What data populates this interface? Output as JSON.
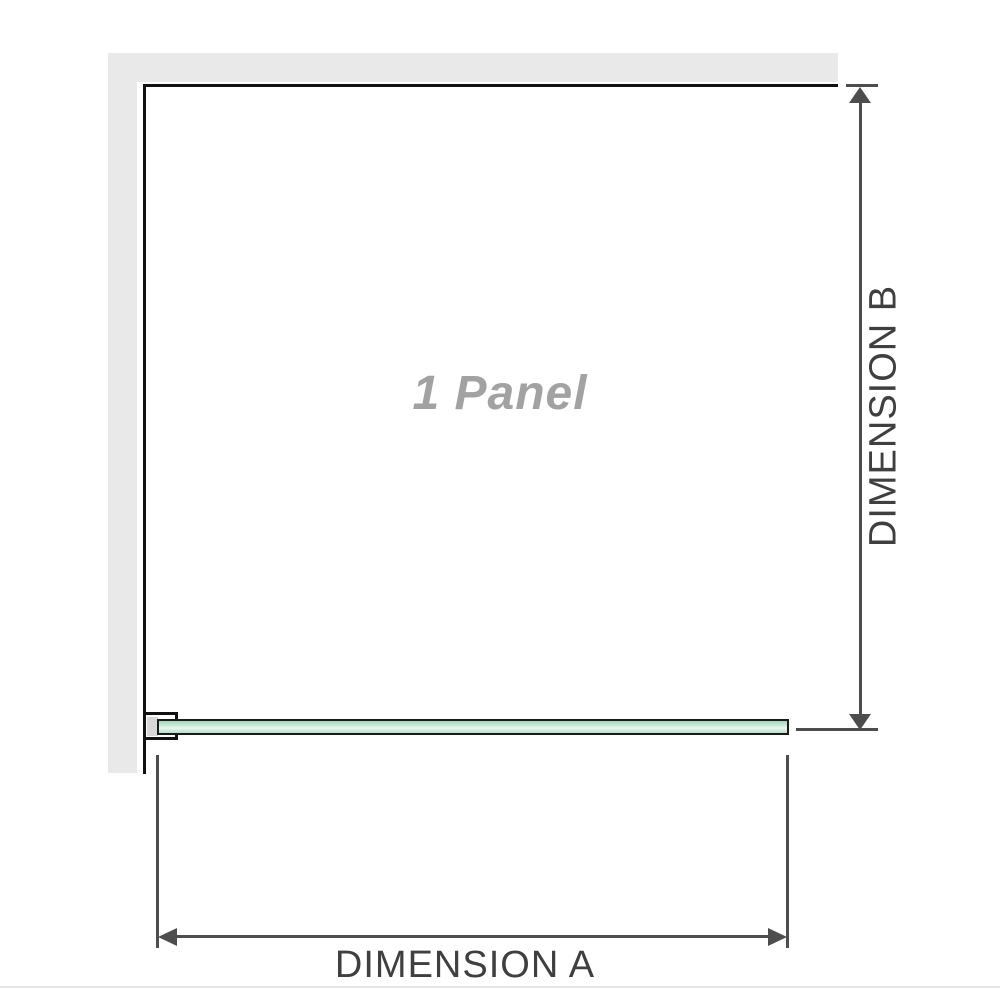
{
  "diagram": {
    "panel_label": "1 Panel",
    "dimension_a_label": "DIMENSION A",
    "dimension_b_label": "DIMENSION B"
  },
  "colors": {
    "wall": "#e9e9e9",
    "outline": "#111111",
    "dimension_line": "#4d4d4d",
    "label_text": "#3f3f3f",
    "panel_label_text": "#a2a2a2",
    "glass_border": "#1b1b1b",
    "glass_green": "#a5d4b8",
    "glass_green_light": "#e9f8ee",
    "separator": "#e2e5e9"
  }
}
